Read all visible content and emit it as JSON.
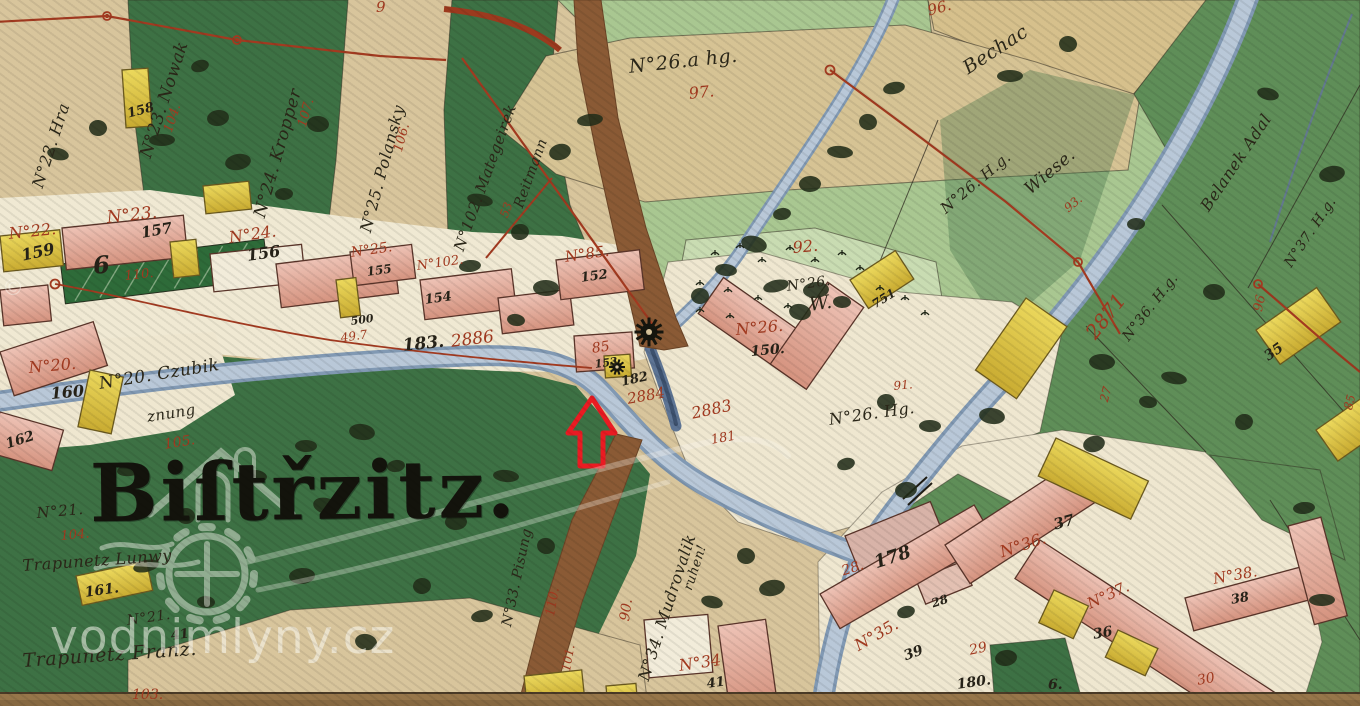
{
  "map": {
    "type": "historical-cadastral-map",
    "village_title": "Biſtřzitz.",
    "watermark": {
      "text": "vodnimlyny.cz",
      "copyright": "©"
    },
    "annotation": {
      "symbol": "red-arrow"
    },
    "labels": [
      {
        "text": "N°22. Hra",
        "x": 30,
        "y": 185,
        "rot": -72,
        "size": 16,
        "style": "cursive"
      },
      {
        "text": "N°23. Nowak",
        "x": 138,
        "y": 155,
        "rot": -72,
        "size": 17,
        "style": "cursive"
      },
      {
        "text": "104.",
        "x": 162,
        "y": 130,
        "rot": -72,
        "size": 13,
        "style": "red"
      },
      {
        "text": "N°24. Kropper",
        "x": 252,
        "y": 215,
        "rot": -74,
        "size": 17,
        "style": "cursive"
      },
      {
        "text": "107.",
        "x": 296,
        "y": 125,
        "rot": -74,
        "size": 13,
        "style": "red"
      },
      {
        "text": "N°25. Polansky",
        "x": 358,
        "y": 230,
        "rot": -75,
        "size": 16,
        "style": "cursive"
      },
      {
        "text": "106.",
        "x": 392,
        "y": 150,
        "rot": -75,
        "size": 13,
        "style": "red"
      },
      {
        "text": "158",
        "x": 126,
        "y": 108,
        "rot": -15,
        "size": 13,
        "style": "black"
      },
      {
        "text": "N°102. Mategeirek",
        "x": 452,
        "y": 248,
        "rot": -70,
        "size": 15,
        "style": "cursive"
      },
      {
        "text": "Reitmann",
        "x": 512,
        "y": 205,
        "rot": -70,
        "size": 14,
        "style": "cursive"
      },
      {
        "text": "53",
        "x": 498,
        "y": 215,
        "rot": -70,
        "size": 12,
        "style": "red"
      },
      {
        "text": "9",
        "x": 376,
        "y": 0,
        "rot": 0,
        "size": 15,
        "style": "red"
      },
      {
        "text": "N°26.a hg.",
        "x": 628,
        "y": 58,
        "rot": -6,
        "size": 19,
        "style": "cursive"
      },
      {
        "text": "97.",
        "x": 688,
        "y": 86,
        "rot": -6,
        "size": 16,
        "style": "red"
      },
      {
        "text": "96.",
        "x": 926,
        "y": 4,
        "rot": -15,
        "size": 15,
        "style": "red"
      },
      {
        "text": "Bechac",
        "x": 960,
        "y": 62,
        "rot": -33,
        "size": 19,
        "style": "cursive"
      },
      {
        "text": "N°26. H.g.",
        "x": 938,
        "y": 205,
        "rot": -40,
        "size": 15,
        "style": "cursive"
      },
      {
        "text": "Wiese.",
        "x": 1022,
        "y": 185,
        "rot": -40,
        "size": 17,
        "style": "cursive"
      },
      {
        "text": "93.",
        "x": 1062,
        "y": 205,
        "rot": -40,
        "size": 12,
        "style": "red"
      },
      {
        "text": "Belanek Adal",
        "x": 1198,
        "y": 205,
        "rot": -56,
        "size": 16,
        "style": "cursive"
      },
      {
        "text": "N°37. H.g.",
        "x": 1282,
        "y": 262,
        "rot": -56,
        "size": 14,
        "style": "cursive"
      },
      {
        "text": "2871",
        "x": 1082,
        "y": 330,
        "rot": -52,
        "size": 20,
        "style": "red"
      },
      {
        "text": "N°36. H.g.",
        "x": 1120,
        "y": 335,
        "rot": -52,
        "size": 14,
        "style": "cursive"
      },
      {
        "text": "27",
        "x": 1098,
        "y": 400,
        "rot": -75,
        "size": 12,
        "style": "red"
      },
      {
        "text": "96",
        "x": 1252,
        "y": 310,
        "rot": -78,
        "size": 13,
        "style": "red"
      },
      {
        "text": "35",
        "x": 1262,
        "y": 352,
        "rot": -35,
        "size": 14,
        "style": "black"
      },
      {
        "text": "85",
        "x": 1342,
        "y": 408,
        "rot": -75,
        "size": 12,
        "style": "red"
      },
      {
        "text": "92.",
        "x": 792,
        "y": 240,
        "rot": -5,
        "size": 16,
        "style": "red"
      },
      {
        "text": "N°26.",
        "x": 786,
        "y": 280,
        "rot": -8,
        "size": 14,
        "style": "cursive"
      },
      {
        "text": "W.",
        "x": 808,
        "y": 296,
        "rot": -8,
        "size": 19,
        "style": "cursive"
      },
      {
        "text": "751",
        "x": 870,
        "y": 300,
        "rot": -32,
        "size": 12,
        "style": "black"
      },
      {
        "text": "N°22.",
        "x": 8,
        "y": 226,
        "rot": -6,
        "size": 16,
        "style": "red"
      },
      {
        "text": "159",
        "x": 20,
        "y": 248,
        "rot": -12,
        "size": 16,
        "style": "black"
      },
      {
        "text": "N°23.",
        "x": 106,
        "y": 210,
        "rot": -6,
        "size": 17,
        "style": "red"
      },
      {
        "text": "157",
        "x": 140,
        "y": 226,
        "rot": -10,
        "size": 15,
        "style": "black"
      },
      {
        "text": "N°24.",
        "x": 228,
        "y": 230,
        "rot": -8,
        "size": 16,
        "style": "red"
      },
      {
        "text": "156",
        "x": 246,
        "y": 248,
        "rot": -8,
        "size": 16,
        "style": "black"
      },
      {
        "text": "N°25.",
        "x": 350,
        "y": 246,
        "rot": -8,
        "size": 14,
        "style": "red"
      },
      {
        "text": "155",
        "x": 366,
        "y": 266,
        "rot": -8,
        "size": 12,
        "style": "black"
      },
      {
        "text": "N°102.",
        "x": 416,
        "y": 260,
        "rot": -8,
        "size": 13,
        "style": "red"
      },
      {
        "text": "154",
        "x": 424,
        "y": 294,
        "rot": -8,
        "size": 13,
        "style": "black"
      },
      {
        "text": "N°85.",
        "x": 564,
        "y": 250,
        "rot": -8,
        "size": 15,
        "style": "red"
      },
      {
        "text": "152",
        "x": 580,
        "y": 272,
        "rot": -8,
        "size": 13,
        "style": "black"
      },
      {
        "text": "110.",
        "x": 124,
        "y": 270,
        "rot": -6,
        "size": 13,
        "style": "red"
      },
      {
        "text": "6",
        "x": 92,
        "y": 254,
        "rot": -5,
        "size": 24,
        "style": "black"
      },
      {
        "text": "N°20.",
        "x": 28,
        "y": 360,
        "rot": -5,
        "size": 16,
        "style": "red"
      },
      {
        "text": "160",
        "x": 50,
        "y": 386,
        "rot": -5,
        "size": 16,
        "style": "black"
      },
      {
        "text": "162",
        "x": 4,
        "y": 438,
        "rot": -18,
        "size": 14,
        "style": "black"
      },
      {
        "text": "N°20. Czubik",
        "x": 98,
        "y": 376,
        "rot": -9,
        "size": 17,
        "style": "cursive"
      },
      {
        "text": "znung",
        "x": 146,
        "y": 410,
        "rot": -9,
        "size": 15,
        "style": "cursive"
      },
      {
        "text": "105.",
        "x": 163,
        "y": 438,
        "rot": -9,
        "size": 14,
        "style": "red"
      },
      {
        "text": "500",
        "x": 350,
        "y": 316,
        "rot": -8,
        "size": 11,
        "style": "black"
      },
      {
        "text": "49.7",
        "x": 340,
        "y": 332,
        "rot": -8,
        "size": 12,
        "style": "red"
      },
      {
        "text": "183.",
        "x": 402,
        "y": 338,
        "rot": -6,
        "size": 17,
        "style": "black"
      },
      {
        "text": "2886",
        "x": 450,
        "y": 334,
        "rot": -7,
        "size": 17,
        "style": "red"
      },
      {
        "text": "85",
        "x": 591,
        "y": 342,
        "rot": -8,
        "size": 14,
        "style": "red"
      },
      {
        "text": "153",
        "x": 594,
        "y": 359,
        "rot": -8,
        "size": 11,
        "style": "black"
      },
      {
        "text": "182",
        "x": 620,
        "y": 376,
        "rot": -12,
        "size": 13,
        "style": "black"
      },
      {
        "text": "2884",
        "x": 626,
        "y": 392,
        "rot": -10,
        "size": 15,
        "style": "red"
      },
      {
        "text": "2883",
        "x": 690,
        "y": 406,
        "rot": -12,
        "size": 16,
        "style": "red"
      },
      {
        "text": "181",
        "x": 710,
        "y": 434,
        "rot": -10,
        "size": 13,
        "style": "red"
      },
      {
        "text": "N°26.",
        "x": 735,
        "y": 322,
        "rot": -5,
        "size": 16,
        "style": "red"
      },
      {
        "text": "150.",
        "x": 750,
        "y": 345,
        "rot": -5,
        "size": 14,
        "style": "black"
      },
      {
        "text": "91.",
        "x": 893,
        "y": 380,
        "rot": -5,
        "size": 12,
        "style": "red"
      },
      {
        "text": "N°26. Hg.",
        "x": 828,
        "y": 412,
        "rot": -8,
        "size": 16,
        "style": "cursive"
      },
      {
        "text": "N°21.",
        "x": 36,
        "y": 506,
        "rot": -5,
        "size": 15,
        "style": "cursive"
      },
      {
        "text": "104.",
        "x": 60,
        "y": 530,
        "rot": -5,
        "size": 13,
        "style": "red"
      },
      {
        "text": "Trapunetz Lunwy",
        "x": 22,
        "y": 558,
        "rot": -4,
        "size": 16,
        "style": "cursive"
      },
      {
        "text": "161.",
        "x": 84,
        "y": 586,
        "rot": -8,
        "size": 14,
        "style": "black"
      },
      {
        "text": "N°21.",
        "x": 126,
        "y": 614,
        "rot": -8,
        "size": 14,
        "style": "cursive"
      },
      {
        "text": "41",
        "x": 170,
        "y": 630,
        "rot": -8,
        "size": 13,
        "style": "black"
      },
      {
        "text": "Trapunetz Franz.",
        "x": 22,
        "y": 652,
        "rot": -4,
        "size": 19,
        "style": "cursive"
      },
      {
        "text": "103.",
        "x": 132,
        "y": 688,
        "rot": 0,
        "size": 14,
        "style": "red"
      },
      {
        "text": "N°33. Pisung",
        "x": 500,
        "y": 625,
        "rot": -78,
        "size": 14,
        "style": "cursive"
      },
      {
        "text": "110.",
        "x": 544,
        "y": 615,
        "rot": -80,
        "size": 13,
        "style": "red"
      },
      {
        "text": "101.",
        "x": 560,
        "y": 670,
        "rot": -80,
        "size": 12,
        "style": "red"
      },
      {
        "text": "90.",
        "x": 618,
        "y": 620,
        "rot": -82,
        "size": 14,
        "style": "red"
      },
      {
        "text": "N°34. Mudrovalik",
        "x": 636,
        "y": 678,
        "rot": -72,
        "size": 16,
        "style": "cursive"
      },
      {
        "text": "ruhen!",
        "x": 682,
        "y": 588,
        "rot": -72,
        "size": 13,
        "style": "cursive"
      },
      {
        "text": "N°34",
        "x": 678,
        "y": 658,
        "rot": -8,
        "size": 16,
        "style": "red"
      },
      {
        "text": "41",
        "x": 706,
        "y": 678,
        "rot": -8,
        "size": 13,
        "style": "black"
      },
      {
        "text": "N°35.",
        "x": 852,
        "y": 640,
        "rot": -30,
        "size": 16,
        "style": "red"
      },
      {
        "text": "39",
        "x": 902,
        "y": 650,
        "rot": -20,
        "size": 14,
        "style": "black"
      },
      {
        "text": "178",
        "x": 872,
        "y": 555,
        "rot": -18,
        "size": 18,
        "style": "black"
      },
      {
        "text": "28.",
        "x": 840,
        "y": 565,
        "rot": -18,
        "size": 14,
        "style": "red"
      },
      {
        "text": "28",
        "x": 930,
        "y": 598,
        "rot": -18,
        "size": 12,
        "style": "black"
      },
      {
        "text": "29",
        "x": 968,
        "y": 644,
        "rot": -12,
        "size": 14,
        "style": "red"
      },
      {
        "text": "180.",
        "x": 956,
        "y": 678,
        "rot": -8,
        "size": 14,
        "style": "black"
      },
      {
        "text": "6.",
        "x": 1048,
        "y": 678,
        "rot": 0,
        "size": 14,
        "style": "black"
      },
      {
        "text": "30",
        "x": 1196,
        "y": 674,
        "rot": -10,
        "size": 14,
        "style": "red"
      },
      {
        "text": "37",
        "x": 1052,
        "y": 518,
        "rot": -15,
        "size": 15,
        "style": "black"
      },
      {
        "text": "N°36.",
        "x": 998,
        "y": 545,
        "rot": -18,
        "size": 16,
        "style": "red"
      },
      {
        "text": "N°37.",
        "x": 1085,
        "y": 598,
        "rot": -25,
        "size": 15,
        "style": "red"
      },
      {
        "text": "36",
        "x": 1092,
        "y": 628,
        "rot": -10,
        "size": 14,
        "style": "black"
      },
      {
        "text": "N°38.",
        "x": 1212,
        "y": 572,
        "rot": -10,
        "size": 15,
        "style": "red"
      },
      {
        "text": "38",
        "x": 1230,
        "y": 594,
        "rot": -10,
        "size": 13,
        "style": "black"
      }
    ]
  }
}
